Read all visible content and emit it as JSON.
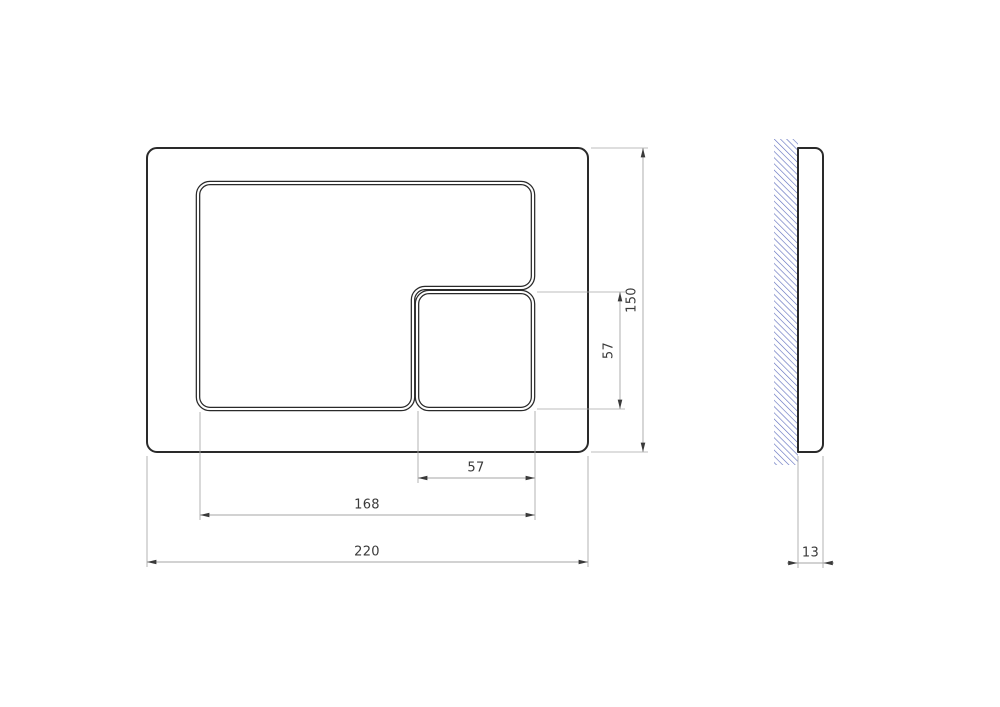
{
  "drawing": {
    "front_view": {
      "dim_overall_width": "220",
      "dim_inner_width": "168",
      "dim_small_button_width": "57",
      "dim_overall_height": "150",
      "dim_small_button_height": "57"
    },
    "side_view": {
      "dim_thickness": "13"
    },
    "colors": {
      "outline": "#2a2a2a",
      "dimension_line": "#a6a6a6",
      "dimension_text": "#3a3a3a",
      "wall_hatch": "#5b6abc",
      "background": "#ffffff"
    }
  }
}
